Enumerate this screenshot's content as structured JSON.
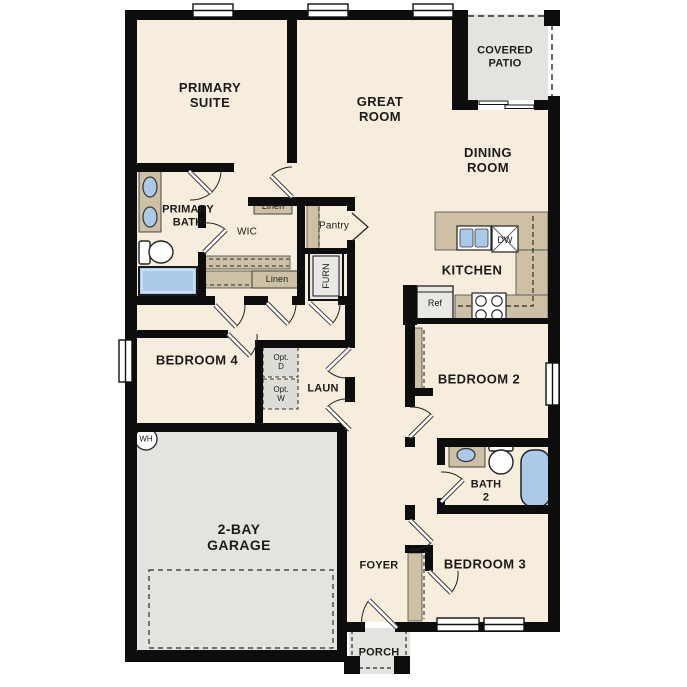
{
  "plan_title": "single-story-floor-plan",
  "colors": {
    "floor": "#f6eddc",
    "wall": "#0d0d0d",
    "counter_tan": "#cdc0a4",
    "concrete_gray": "#e4e3e0",
    "fixture_blue": "#abcaea",
    "appliance_gray": "#e9e8e4",
    "text": "#1b1b1b"
  },
  "labels": {
    "primary_suite": "PRIMARY\nSUITE",
    "great_room": "GREAT\nROOM",
    "covered_patio": "COVERED\nPATIO",
    "dining_room": "DINING\nROOM",
    "primary_bath": "PRIMARY\nBATH",
    "wic": "WIC",
    "linen_upper": "Linen",
    "linen_lower": "Linen",
    "pantry": "Pantry",
    "furnace": "FURN",
    "kitchen": "KITCHEN",
    "refrigerator": "Ref",
    "dishwasher": "DW",
    "bedroom4": "BEDROOM 4",
    "opt_dryer": "Opt.\nD",
    "opt_washer": "Opt.\nW",
    "laundry": "LAUN",
    "water_heater": "WH",
    "bedroom2": "BEDROOM 2",
    "bath2": "BATH\n2",
    "garage": "2-BAY\nGARAGE",
    "foyer": "FOYER",
    "bedroom3": "BEDROOM 3",
    "porch": "PORCH"
  }
}
